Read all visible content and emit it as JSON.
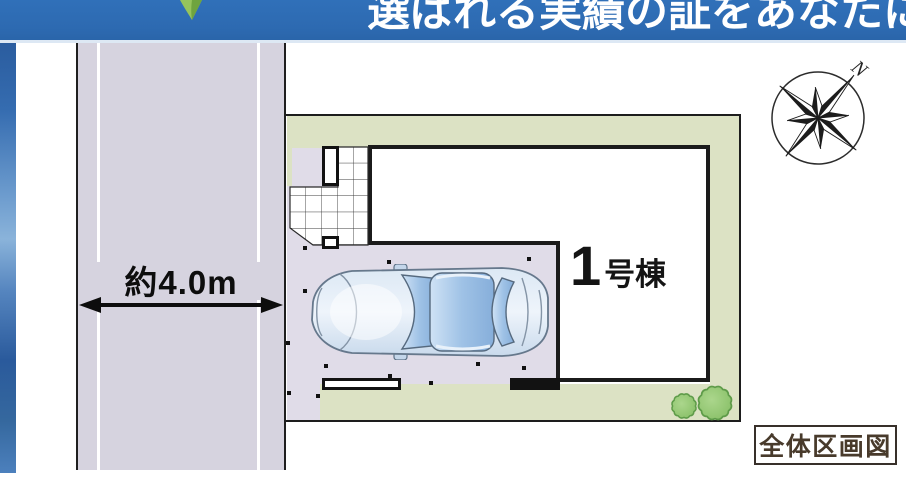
{
  "banner": {
    "headline": "選ばれる実績の証をあなたにも",
    "bg_color": "#2e6cb4",
    "text_color": "#ffffff"
  },
  "site_plan": {
    "road": {
      "width_label": "約4.0m"
    },
    "building": {
      "number": "1",
      "suffix": "号棟"
    },
    "caption": "全体区画図",
    "compass": {
      "north_label": "N"
    },
    "icons": {
      "compass": "compass-rose-icon",
      "leaf": "leaf-icon",
      "bushes": "bush-icon",
      "car": "car-top-view-icon",
      "dimension_arrow": "double-arrow-icon"
    },
    "colors": {
      "road_fill": "#d6d3df",
      "parking_fill": "#e0dce8",
      "landscape_fill": "#dce2c4",
      "bush_fill": "#92c573",
      "outline": "#1d1d1d",
      "caption_text": "#483a2b",
      "banner_blue": "#2e6cb4"
    }
  }
}
